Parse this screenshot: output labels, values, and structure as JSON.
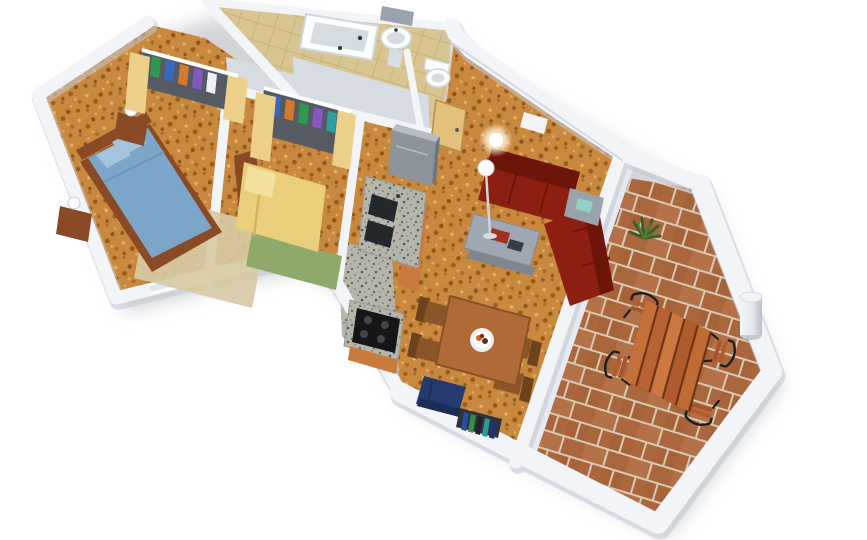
{
  "scene": {
    "title": "3D isometric render of an apartment floor plan, white walls on a white background",
    "view": "top-down axonometric, rotated about 17 degrees"
  },
  "rooms": [
    {
      "name": "Master bedroom",
      "floor": "cork",
      "furniture": [
        "double bed with blue bedding",
        "two wooden nightstands with white lamps",
        "open wardrobe with clothes",
        "beige rug"
      ]
    },
    {
      "name": "Second bedroom",
      "floor": "cork",
      "furniture": [
        "single bed with yellow bedding",
        "open wardrobe with clothes",
        "green rug"
      ]
    },
    {
      "name": "Bathroom",
      "floor": "beige tile",
      "furniture": [
        "bathtub",
        "pedestal sink",
        "mirror shelf"
      ]
    },
    {
      "name": "WC",
      "floor": "beige tile",
      "furniture": [
        "toilet"
      ]
    },
    {
      "name": "Hall",
      "floor": "cork",
      "furniture": [
        "wooden entry door"
      ]
    },
    {
      "name": "Kitchen",
      "floor": "speckled grey tile",
      "furniture": [
        "refrigerator",
        "counter with two sinks",
        "stove with four burners",
        "orange wood cabinets"
      ]
    },
    {
      "name": "Living and dining room",
      "floor": "cork",
      "furniture": [
        "dark red corner sofa",
        "grey coffee table",
        "grey side table with teal box",
        "floor lamp",
        "wall light",
        "wooden dining table with fruit plate",
        "four wooden chairs",
        "navy armchair",
        "low bookshelf"
      ]
    },
    {
      "name": "Terrace",
      "floor": "terracotta tile",
      "furniture": [
        "slatted wooden table",
        "four wrought iron chairs",
        "white column",
        "green plant"
      ]
    }
  ],
  "colors": {
    "background": "#ffffff",
    "wall": "#f2f4f8",
    "wall_shadow": "#c2c8d2",
    "wall_face": "#d7dce3",
    "wall_face_light": "#e6eaf0",
    "cork_floor": "#c8883e",
    "terrace_tile": "#aa663c",
    "terrace_tile_alt": "#b47046",
    "terrace_grout": "#d8c9b5",
    "bath_tile": "#d9c591",
    "bath_grout": "#c3ae77",
    "kitchen_floor": "#b5b5ac",
    "counter_top": "#c6c6bc",
    "sink_basin": "#23282c",
    "stove_black": "#161616",
    "burner_gray": "#41464c",
    "fridge_gray": "#8d939b",
    "fridge_light": "#b6bcc4",
    "cabinet_wood": "#c97a3e",
    "door_wood": "#e3c17c",
    "wardrobe_door": "#ecd089",
    "wardrobe_interior": "#565b63",
    "bed_blue": "#7ba6c9",
    "bed_blue_light": "#a3c4db",
    "bed_frame_wood": "#8a4a26",
    "bed_yellow": "#e9ce7c",
    "bed_yellow_light": "#f2e09f",
    "rug_beige": "#d7c9a4",
    "rug_green": "#8fa96b",
    "sofa_red": "#8c1f12",
    "sofa_red_dark": "#6e150a",
    "table_gray": "#9aa2ab",
    "teal_box": "#8fd0c8",
    "coffee_table_gray": "#9fa8b2",
    "dining_wood": "#b06a38",
    "chair_wood": "#8a5528",
    "chair_wood_dark": "#6f421e",
    "armchair_navy": "#253a6e",
    "armchair_navy_dark": "#1c2d58",
    "shelf_dark": "#2f343a",
    "terrace_table_wood": "#c06a36",
    "plank_base": "#6e3416",
    "iron_black": "#1d1d1d",
    "column_light": "#f2f4f6",
    "column_shade": "#c3c9d3",
    "plant_green": "#3f5d26",
    "plant_green_light": "#54803a",
    "porcelain": "#fbfdfe",
    "porcelain_shade": "#d5dde3",
    "mirror_gray": "#9aa3ad",
    "lamp_white": "#fafbfc",
    "window_glass": "#dce8f0"
  },
  "clothes_colors": [
    "#2f9a4d",
    "#3a66c4",
    "#d8782a",
    "#8757c2",
    "#eef0f2",
    "#2aa0a0"
  ],
  "book_colors": [
    "#2a4da0",
    "#3a8a4a",
    "#22262c",
    "#2f9a9a",
    "#24306e"
  ]
}
